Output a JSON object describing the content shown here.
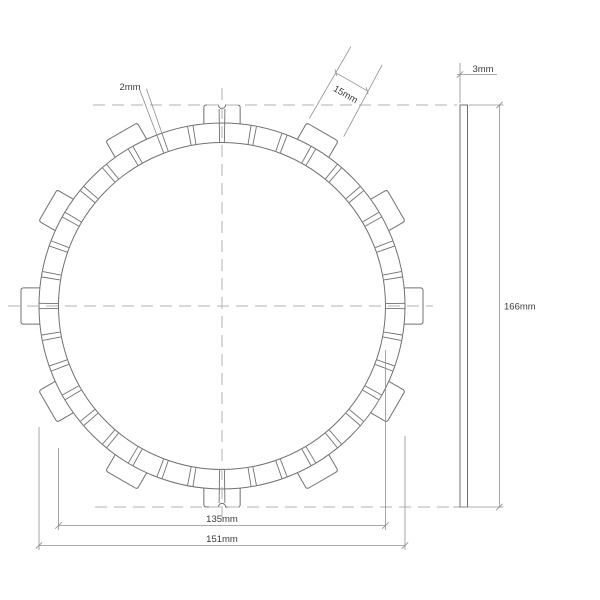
{
  "drawing": {
    "description": "Clutch friction plate technical drawing with plan view and side (thickness) view",
    "views": {
      "plan": "friction disc with drive tabs",
      "side": "plate thickness strip"
    }
  },
  "dimensions": {
    "slot_width": {
      "label": "2mm"
    },
    "tab_width": {
      "label": "15mm"
    },
    "thickness": {
      "label": "3mm"
    },
    "overall_diameter": {
      "label": "166mm"
    },
    "friction_inner_diameter": {
      "label": "135mm"
    },
    "friction_outer_diameter": {
      "label": "151mm"
    }
  },
  "geometry": {
    "center_x": 222,
    "center_y": 306,
    "px_per_mm": 2.42,
    "outer_radius": 183,
    "inner_radius": 163.5,
    "tab_outer_radius": 201,
    "tab_width_px": 36.3,
    "notch_radius_px": 3.6,
    "tab_angles_deg": [
      0,
      30,
      60,
      90,
      120,
      150,
      180,
      210,
      240,
      270,
      300,
      330
    ],
    "notched_tab_angles_deg": [
      90,
      270
    ],
    "slot_step_deg": 10,
    "slot_half_angle_deg": 0.85,
    "side_view": {
      "x": 460,
      "y": 105,
      "width": 7.5,
      "height": 402
    },
    "colors": {
      "line": "#707070",
      "centerline": "#b0b0b0",
      "dimension": "#8f8f8f",
      "text": "#3c3c3c",
      "background": "#ffffff"
    }
  }
}
